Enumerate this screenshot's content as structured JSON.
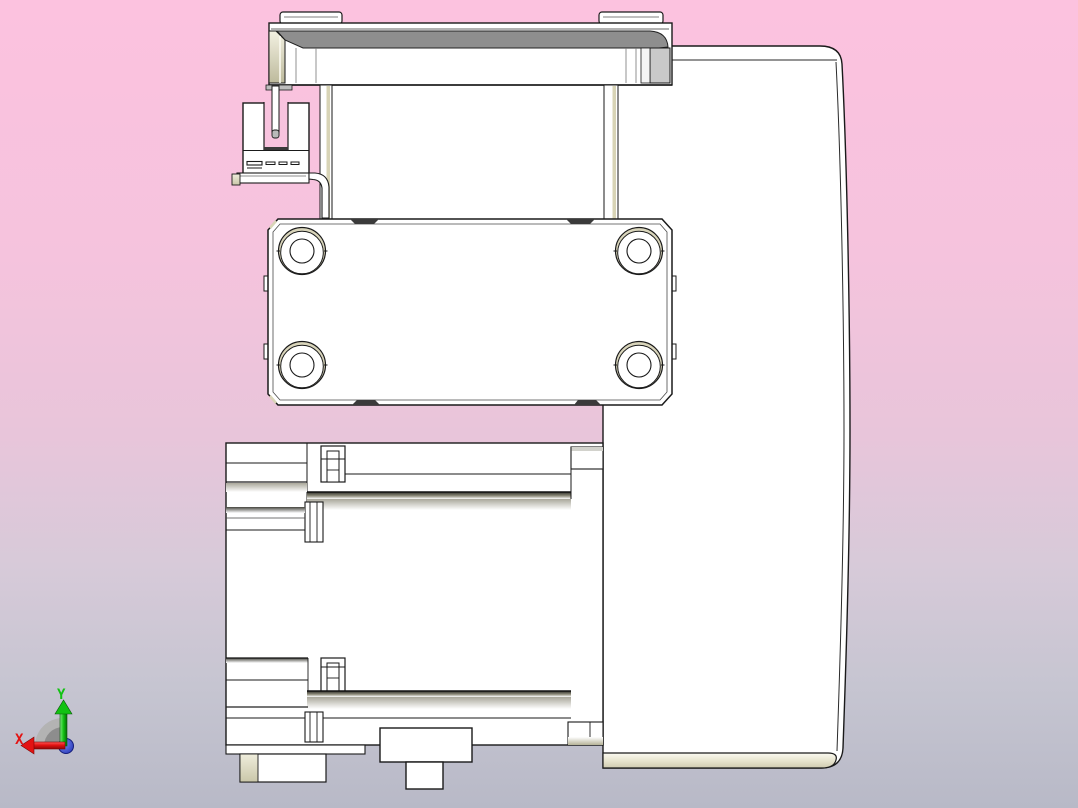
{
  "canvas": {
    "width": 1078,
    "height": 808
  },
  "background": {
    "gradient_top": "#fcc2df",
    "gradient_upper": "#f5c3dd",
    "gradient_mid": "#e8c5da",
    "gradient_lower": "#d7cad9",
    "gradient_lavender": "#c6c5d1",
    "gradient_bottom": "#b8b9c7"
  },
  "model": {
    "body_fill": "#ffffff",
    "outline_color": "#1a1a1a",
    "top_face_gray": "#8e8e8e",
    "chamfer_beige": "#d8d4b6",
    "end_cap_gray": "#c9c9c9",
    "slot_mark_dark": "#3a3a3a",
    "sensor_slot_fill": "#f8c3de"
  },
  "axis_triad": {
    "x_label": "X",
    "y_label": "Y",
    "x_color": "#e31212",
    "y_color": "#12c212",
    "z_dot_color": "#2233cc",
    "arc_light": "#b3b3b3",
    "arc_dark": "#8d8d8d"
  }
}
